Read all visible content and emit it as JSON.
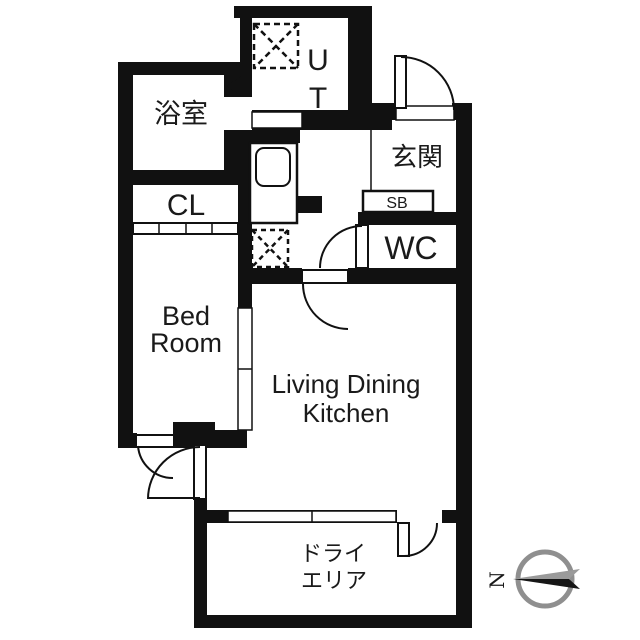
{
  "plan": {
    "rooms": {
      "bathroom": "浴室",
      "closet": "CL",
      "bedroom_line1": "Bed",
      "bedroom_line2": "Room",
      "ldk_line1": "Living Dining",
      "ldk_line2": "Kitchen",
      "entrance": "玄関",
      "shoebox": "SB",
      "toilet": "WC",
      "utility_line1": "U",
      "utility_line2": "T",
      "dryarea_line1": "ドライ",
      "dryarea_line2": "エリア"
    },
    "compass": {
      "north_label": "N"
    },
    "colors": {
      "wall": "#111111",
      "paper": "#ffffff",
      "compass_ring": "#8f8f8f",
      "needle_dark": "#161616",
      "needle_light": "#9a9a9a"
    }
  }
}
